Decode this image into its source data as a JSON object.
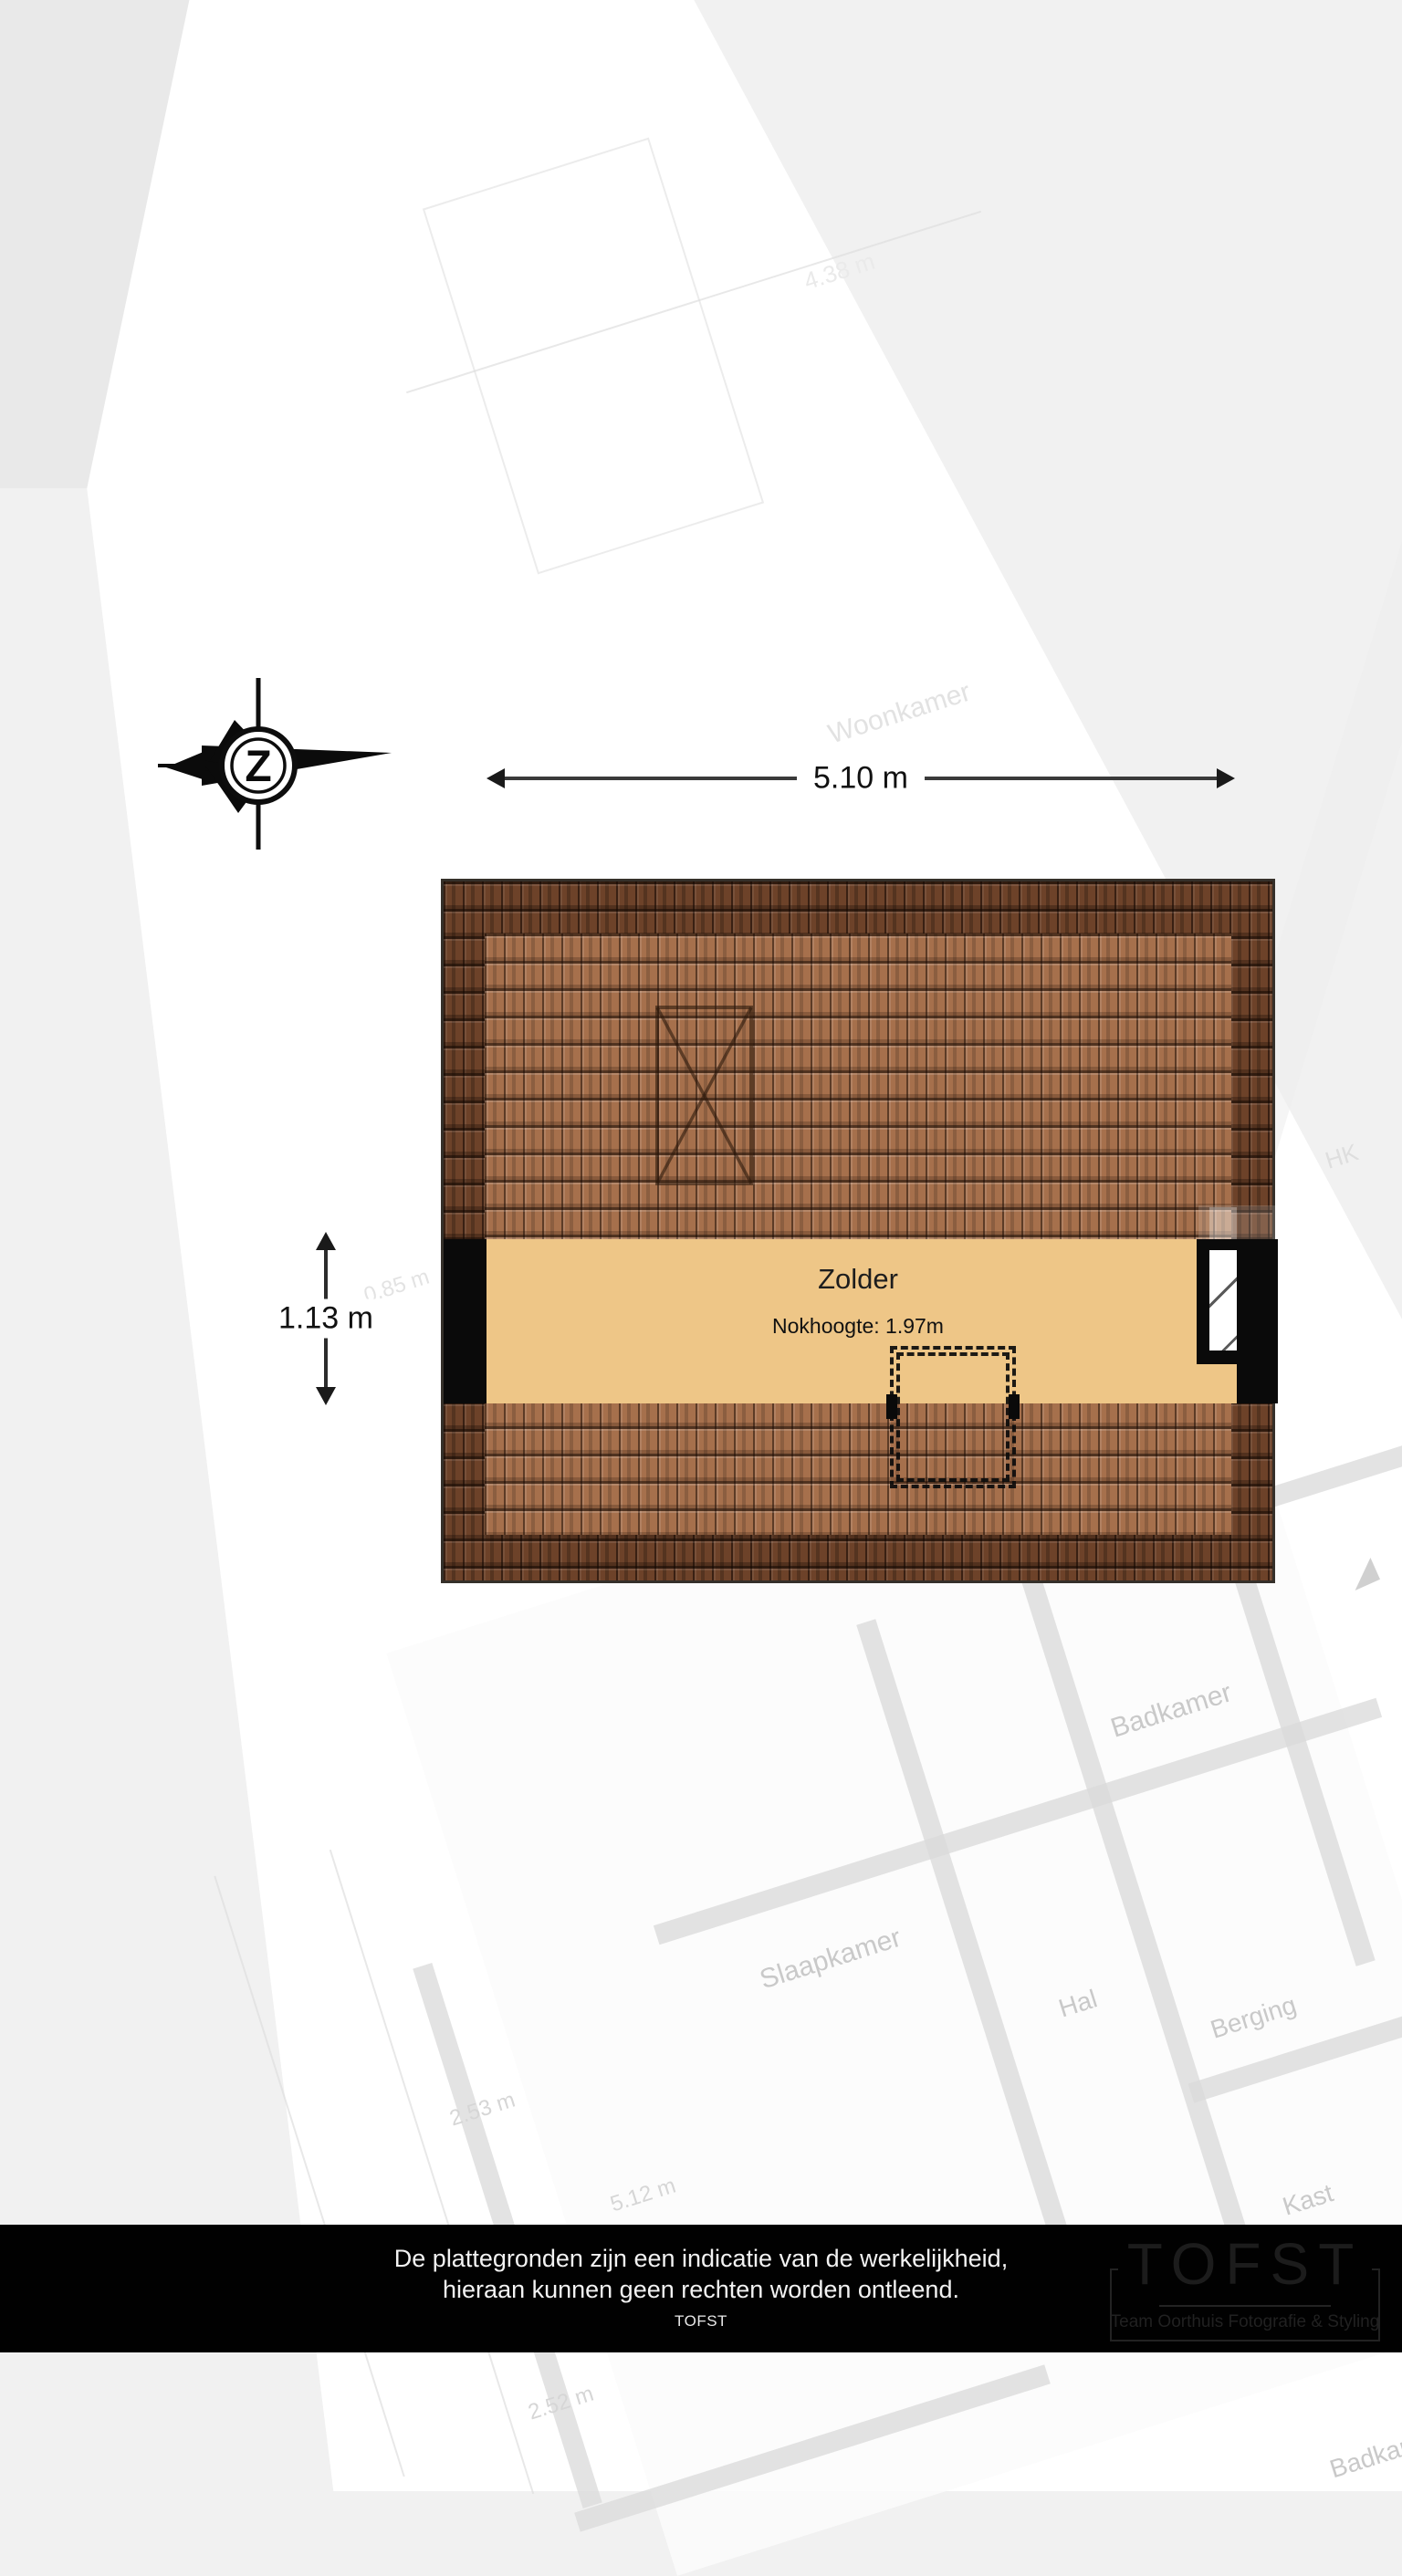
{
  "compass": {
    "letter": "Z"
  },
  "dimensions": {
    "width_label": "5.10 m",
    "height_label": "1.13 m"
  },
  "plan": {
    "room_label": "Zolder",
    "ridge_label": "Nokhoogte: 1.97m",
    "colors": {
      "roof_dark": "#6d4229",
      "roof_light": "#a6704c",
      "floor": "#eec687",
      "wall": "#0a0a0a"
    }
  },
  "footer": {
    "bg": "#010101",
    "line1": "De plattegronden zijn een indicatie van de werkelijkheid,",
    "line2": "hieraan kunnen geen rechten worden ontleend.",
    "brand": "TOFST",
    "logo": {
      "title": "TOFST",
      "subtitle": "Team Oorthuis Fotografie & Styling"
    }
  },
  "ghost": {
    "labels": [
      {
        "text": "Woonkamer"
      },
      {
        "text": "Badkamer"
      },
      {
        "text": "Slaapkamer"
      },
      {
        "text": "Hal"
      },
      {
        "text": "Berging"
      },
      {
        "text": "Kast"
      },
      {
        "text": "Badkamer"
      },
      {
        "text": "HK"
      }
    ],
    "dims": [
      {
        "text": "4.38 m"
      },
      {
        "text": "0.85 m"
      },
      {
        "text": "2.53 m"
      },
      {
        "text": "5.12 m"
      },
      {
        "text": "2.52 m"
      }
    ]
  }
}
